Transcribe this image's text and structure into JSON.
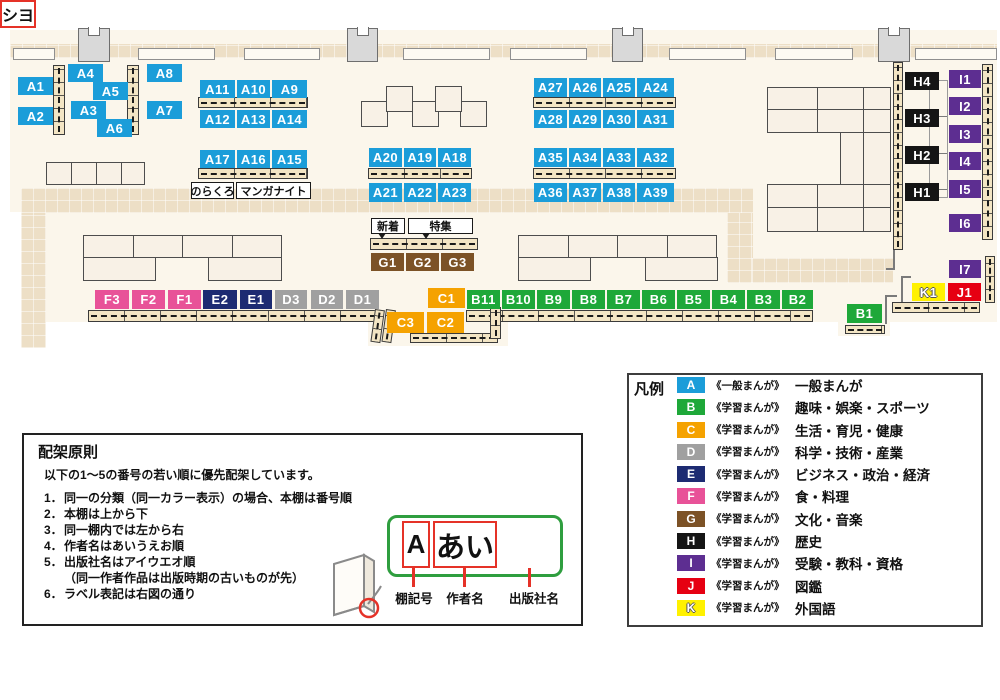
{
  "palette": {
    "A": "#1B9DD9",
    "B": "#1EA839",
    "C": "#F5A200",
    "D": "#A0A0A0",
    "E": "#1D2B72",
    "F": "#E85298",
    "G": "#7C5226",
    "H": "#151515",
    "I": "#5D2E91",
    "J": "#E60012",
    "K": "#FFF100"
  },
  "map": {
    "floor": {
      "x": 10,
      "y": 30,
      "w": 987,
      "h": 292
    },
    "floor_extensions": [
      {
        "x": 368,
        "y": 322,
        "w": 140,
        "h": 24
      },
      {
        "x": 838,
        "y": 322,
        "w": 52,
        "h": 14
      }
    ],
    "white_patches": [
      {
        "x": 0,
        "y": 212,
        "w": 21,
        "h": 110
      }
    ],
    "walkways": [
      {
        "x": 10,
        "y": 44,
        "w": 987,
        "h": 14
      },
      {
        "x": 21,
        "y": 188,
        "w": 25,
        "h": 160
      },
      {
        "x": 21,
        "y": 188,
        "w": 732,
        "h": 25
      },
      {
        "x": 727,
        "y": 213,
        "w": 26,
        "h": 70
      },
      {
        "x": 752,
        "y": 258,
        "w": 141,
        "h": 25
      }
    ],
    "wall_segments": [
      {
        "x": 13,
        "y": 48,
        "w": 42,
        "h": 12
      },
      {
        "x": 138,
        "y": 48,
        "w": 77,
        "h": 12
      },
      {
        "x": 244,
        "y": 48,
        "w": 76,
        "h": 12
      },
      {
        "x": 403,
        "y": 48,
        "w": 87,
        "h": 12
      },
      {
        "x": 510,
        "y": 48,
        "w": 77,
        "h": 12
      },
      {
        "x": 669,
        "y": 48,
        "w": 77,
        "h": 12
      },
      {
        "x": 775,
        "y": 48,
        "w": 78,
        "h": 12
      },
      {
        "x": 915,
        "y": 48,
        "w": 82,
        "h": 12
      }
    ],
    "pillars": [
      {
        "x": 78,
        "y": 28,
        "w": 32,
        "h": 34
      },
      {
        "x": 347,
        "y": 28,
        "w": 31,
        "h": 34
      },
      {
        "x": 612,
        "y": 28,
        "w": 31,
        "h": 34
      },
      {
        "x": 878,
        "y": 28,
        "w": 32,
        "h": 34
      }
    ],
    "tables": [
      {
        "x": 46,
        "y": 162,
        "w": 26,
        "h": 23
      },
      {
        "x": 71,
        "y": 162,
        "w": 26,
        "h": 23
      },
      {
        "x": 96,
        "y": 162,
        "w": 26,
        "h": 23
      },
      {
        "x": 121,
        "y": 162,
        "w": 24,
        "h": 23
      },
      {
        "x": 83,
        "y": 235,
        "w": 51,
        "h": 23
      },
      {
        "x": 133,
        "y": 235,
        "w": 50,
        "h": 23
      },
      {
        "x": 182,
        "y": 235,
        "w": 51,
        "h": 23
      },
      {
        "x": 232,
        "y": 235,
        "w": 50,
        "h": 23
      },
      {
        "x": 83,
        "y": 257,
        "w": 73,
        "h": 24
      },
      {
        "x": 208,
        "y": 257,
        "w": 74,
        "h": 24
      },
      {
        "x": 518,
        "y": 235,
        "w": 51,
        "h": 23
      },
      {
        "x": 568,
        "y": 235,
        "w": 50,
        "h": 23
      },
      {
        "x": 617,
        "y": 235,
        "w": 51,
        "h": 23
      },
      {
        "x": 667,
        "y": 235,
        "w": 50,
        "h": 23
      },
      {
        "x": 518,
        "y": 257,
        "w": 73,
        "h": 24
      },
      {
        "x": 645,
        "y": 257,
        "w": 73,
        "h": 24
      },
      {
        "x": 361,
        "y": 101,
        "w": 27,
        "h": 26
      },
      {
        "x": 412,
        "y": 101,
        "w": 27,
        "h": 26
      },
      {
        "x": 460,
        "y": 101,
        "w": 27,
        "h": 26
      },
      {
        "x": 386,
        "y": 86,
        "w": 27,
        "h": 26
      },
      {
        "x": 435,
        "y": 86,
        "w": 27,
        "h": 26
      },
      {
        "x": 767,
        "y": 87,
        "w": 51,
        "h": 23
      },
      {
        "x": 817,
        "y": 87,
        "w": 47,
        "h": 23
      },
      {
        "x": 863,
        "y": 87,
        "w": 28,
        "h": 23
      },
      {
        "x": 767,
        "y": 109,
        "w": 51,
        "h": 24
      },
      {
        "x": 817,
        "y": 109,
        "w": 47,
        "h": 24
      },
      {
        "x": 863,
        "y": 109,
        "w": 28,
        "h": 24
      },
      {
        "x": 840,
        "y": 132,
        "w": 24,
        "h": 53
      },
      {
        "x": 863,
        "y": 132,
        "w": 28,
        "h": 53
      },
      {
        "x": 767,
        "y": 184,
        "w": 51,
        "h": 24
      },
      {
        "x": 817,
        "y": 184,
        "w": 47,
        "h": 24
      },
      {
        "x": 863,
        "y": 184,
        "w": 28,
        "h": 24
      },
      {
        "x": 767,
        "y": 207,
        "w": 51,
        "h": 25
      },
      {
        "x": 817,
        "y": 207,
        "w": 47,
        "h": 25
      },
      {
        "x": 863,
        "y": 207,
        "w": 28,
        "h": 25
      }
    ],
    "shelves_h": [
      {
        "x": 198,
        "y": 97,
        "w": 110,
        "h": 11
      },
      {
        "x": 198,
        "y": 168,
        "w": 110,
        "h": 11
      },
      {
        "x": 368,
        "y": 168,
        "w": 104,
        "h": 11
      },
      {
        "x": 533,
        "y": 97,
        "w": 143,
        "h": 11
      },
      {
        "x": 533,
        "y": 168,
        "w": 143,
        "h": 11
      },
      {
        "x": 370,
        "y": 238,
        "w": 108,
        "h": 12
      },
      {
        "x": 88,
        "y": 310,
        "w": 291,
        "h": 12
      },
      {
        "x": 466,
        "y": 310,
        "w": 347,
        "h": 12
      },
      {
        "x": 845,
        "y": 325,
        "w": 40,
        "h": 9
      },
      {
        "x": 410,
        "y": 333,
        "w": 88,
        "h": 10
      },
      {
        "x": 892,
        "y": 302,
        "w": 88,
        "h": 11
      }
    ],
    "shelves_v": [
      {
        "x": 53,
        "y": 65,
        "w": 12,
        "h": 70
      },
      {
        "x": 127,
        "y": 65,
        "w": 12,
        "h": 70
      },
      {
        "x": 893,
        "y": 62,
        "w": 10,
        "h": 188
      },
      {
        "x": 982,
        "y": 64,
        "w": 11,
        "h": 176
      },
      {
        "x": 985,
        "y": 256,
        "w": 10,
        "h": 47
      },
      {
        "x": 375,
        "y": 309,
        "w": 10,
        "h": 33,
        "r": 8
      },
      {
        "x": 386,
        "y": 309,
        "w": 10,
        "h": 33,
        "r": 8
      },
      {
        "x": 490,
        "y": 307,
        "w": 11,
        "h": 32
      }
    ],
    "lines": [
      {
        "x": 893,
        "y": 234,
        "w": 2,
        "h": 36
      },
      {
        "x": 886,
        "y": 268,
        "w": 9,
        "h": 2
      },
      {
        "x": 901,
        "y": 276,
        "w": 2,
        "h": 30
      },
      {
        "x": 901,
        "y": 276,
        "w": 10,
        "h": 2
      },
      {
        "x": 885,
        "y": 296,
        "w": 2,
        "h": 28
      },
      {
        "x": 885,
        "y": 295,
        "w": 12,
        "h": 2
      },
      {
        "x": 929,
        "y": 116,
        "w": 19,
        "h": 1
      },
      {
        "x": 929,
        "y": 153,
        "w": 19,
        "h": 1
      },
      {
        "x": 929,
        "y": 189,
        "w": 19,
        "h": 1
      }
    ],
    "frames": [
      {
        "x": 929,
        "y": 80,
        "w": 19,
        "h": 118
      }
    ],
    "labels": [
      {
        "t": "A1",
        "c": "A",
        "x": 18,
        "y": 77,
        "w": 35,
        "h": 18
      },
      {
        "t": "A2",
        "c": "A",
        "x": 18,
        "y": 107,
        "w": 35,
        "h": 18
      },
      {
        "t": "A4",
        "c": "A",
        "x": 68,
        "y": 64,
        "w": 35,
        "h": 18
      },
      {
        "t": "A5",
        "c": "A",
        "x": 93,
        "y": 82,
        "w": 35,
        "h": 18
      },
      {
        "t": "A3",
        "c": "A",
        "x": 71,
        "y": 101,
        "w": 35,
        "h": 18
      },
      {
        "t": "A6",
        "c": "A",
        "x": 97,
        "y": 119,
        "w": 35,
        "h": 18
      },
      {
        "t": "A8",
        "c": "A",
        "x": 147,
        "y": 64,
        "w": 35,
        "h": 18
      },
      {
        "t": "A7",
        "c": "A",
        "x": 147,
        "y": 101,
        "w": 35,
        "h": 18
      },
      {
        "t": "A11",
        "c": "A",
        "x": 200,
        "y": 80,
        "w": 35,
        "h": 18
      },
      {
        "t": "A10",
        "c": "A",
        "x": 237,
        "y": 80,
        "w": 33,
        "h": 18
      },
      {
        "t": "A9",
        "c": "A",
        "x": 272,
        "y": 80,
        "w": 35,
        "h": 18
      },
      {
        "t": "A12",
        "c": "A",
        "x": 200,
        "y": 110,
        "w": 35,
        "h": 18
      },
      {
        "t": "A13",
        "c": "A",
        "x": 237,
        "y": 110,
        "w": 33,
        "h": 18
      },
      {
        "t": "A14",
        "c": "A",
        "x": 272,
        "y": 110,
        "w": 35,
        "h": 18
      },
      {
        "t": "A17",
        "c": "A",
        "x": 200,
        "y": 150,
        "w": 35,
        "h": 18
      },
      {
        "t": "A16",
        "c": "A",
        "x": 237,
        "y": 150,
        "w": 33,
        "h": 18
      },
      {
        "t": "A15",
        "c": "A",
        "x": 272,
        "y": 150,
        "w": 35,
        "h": 18
      },
      {
        "t": "A20",
        "c": "A",
        "x": 369,
        "y": 148,
        "w": 33,
        "h": 19
      },
      {
        "t": "A19",
        "c": "A",
        "x": 404,
        "y": 148,
        "w": 32,
        "h": 19
      },
      {
        "t": "A18",
        "c": "A",
        "x": 438,
        "y": 148,
        "w": 33,
        "h": 19
      },
      {
        "t": "A21",
        "c": "A",
        "x": 369,
        "y": 183,
        "w": 33,
        "h": 19
      },
      {
        "t": "A22",
        "c": "A",
        "x": 404,
        "y": 183,
        "w": 32,
        "h": 19
      },
      {
        "t": "A23",
        "c": "A",
        "x": 438,
        "y": 183,
        "w": 33,
        "h": 19
      },
      {
        "t": "A27",
        "c": "A",
        "x": 534,
        "y": 78,
        "w": 33,
        "h": 19
      },
      {
        "t": "A26",
        "c": "A",
        "x": 569,
        "y": 78,
        "w": 32,
        "h": 19
      },
      {
        "t": "A25",
        "c": "A",
        "x": 603,
        "y": 78,
        "w": 32,
        "h": 19
      },
      {
        "t": "A24",
        "c": "A",
        "x": 637,
        "y": 78,
        "w": 37,
        "h": 19
      },
      {
        "t": "A28",
        "c": "A",
        "x": 534,
        "y": 110,
        "w": 33,
        "h": 18
      },
      {
        "t": "A29",
        "c": "A",
        "x": 569,
        "y": 110,
        "w": 32,
        "h": 18
      },
      {
        "t": "A30",
        "c": "A",
        "x": 603,
        "y": 110,
        "w": 32,
        "h": 18
      },
      {
        "t": "A31",
        "c": "A",
        "x": 637,
        "y": 110,
        "w": 37,
        "h": 18
      },
      {
        "t": "A35",
        "c": "A",
        "x": 534,
        "y": 148,
        "w": 33,
        "h": 19
      },
      {
        "t": "A34",
        "c": "A",
        "x": 569,
        "y": 148,
        "w": 32,
        "h": 19
      },
      {
        "t": "A33",
        "c": "A",
        "x": 603,
        "y": 148,
        "w": 32,
        "h": 19
      },
      {
        "t": "A32",
        "c": "A",
        "x": 637,
        "y": 148,
        "w": 37,
        "h": 19
      },
      {
        "t": "A36",
        "c": "A",
        "x": 534,
        "y": 183,
        "w": 33,
        "h": 19
      },
      {
        "t": "A37",
        "c": "A",
        "x": 569,
        "y": 183,
        "w": 32,
        "h": 19
      },
      {
        "t": "A38",
        "c": "A",
        "x": 603,
        "y": 183,
        "w": 32,
        "h": 19
      },
      {
        "t": "A39",
        "c": "A",
        "x": 637,
        "y": 183,
        "w": 37,
        "h": 19
      },
      {
        "t": "G1",
        "c": "G",
        "x": 371,
        "y": 253,
        "w": 33,
        "h": 18
      },
      {
        "t": "G2",
        "c": "G",
        "x": 406,
        "y": 253,
        "w": 33,
        "h": 18
      },
      {
        "t": "G3",
        "c": "G",
        "x": 441,
        "y": 253,
        "w": 33,
        "h": 18
      },
      {
        "t": "F3",
        "c": "F",
        "x": 95,
        "y": 290,
        "w": 34,
        "h": 19
      },
      {
        "t": "F2",
        "c": "F",
        "x": 132,
        "y": 290,
        "w": 33,
        "h": 19
      },
      {
        "t": "F1",
        "c": "F",
        "x": 168,
        "y": 290,
        "w": 33,
        "h": 19
      },
      {
        "t": "E2",
        "c": "E",
        "x": 203,
        "y": 290,
        "w": 34,
        "h": 19
      },
      {
        "t": "E1",
        "c": "E",
        "x": 240,
        "y": 290,
        "w": 32,
        "h": 19
      },
      {
        "t": "D3",
        "c": "D",
        "x": 275,
        "y": 290,
        "w": 32,
        "h": 19
      },
      {
        "t": "D2",
        "c": "D",
        "x": 311,
        "y": 290,
        "w": 32,
        "h": 19
      },
      {
        "t": "D1",
        "c": "D",
        "x": 346,
        "y": 290,
        "w": 33,
        "h": 19
      },
      {
        "t": "C1",
        "c": "C",
        "x": 428,
        "y": 288,
        "w": 37,
        "h": 20
      },
      {
        "t": "C3",
        "c": "C",
        "x": 387,
        "y": 312,
        "w": 37,
        "h": 21
      },
      {
        "t": "C2",
        "c": "C",
        "x": 427,
        "y": 312,
        "w": 37,
        "h": 21
      },
      {
        "t": "B11",
        "c": "B",
        "x": 467,
        "y": 290,
        "w": 33,
        "h": 19
      },
      {
        "t": "B10",
        "c": "B",
        "x": 502,
        "y": 290,
        "w": 33,
        "h": 19
      },
      {
        "t": "B9",
        "c": "B",
        "x": 537,
        "y": 290,
        "w": 33,
        "h": 19
      },
      {
        "t": "B8",
        "c": "B",
        "x": 572,
        "y": 290,
        "w": 33,
        "h": 19
      },
      {
        "t": "B7",
        "c": "B",
        "x": 607,
        "y": 290,
        "w": 33,
        "h": 19
      },
      {
        "t": "B6",
        "c": "B",
        "x": 642,
        "y": 290,
        "w": 33,
        "h": 19
      },
      {
        "t": "B5",
        "c": "B",
        "x": 677,
        "y": 290,
        "w": 33,
        "h": 19
      },
      {
        "t": "B4",
        "c": "B",
        "x": 712,
        "y": 290,
        "w": 33,
        "h": 19
      },
      {
        "t": "B3",
        "c": "B",
        "x": 747,
        "y": 290,
        "w": 33,
        "h": 19
      },
      {
        "t": "B2",
        "c": "B",
        "x": 782,
        "y": 290,
        "w": 31,
        "h": 19
      },
      {
        "t": "B1",
        "c": "B",
        "x": 847,
        "y": 304,
        "w": 35,
        "h": 19
      },
      {
        "t": "H4",
        "c": "H",
        "x": 905,
        "y": 72,
        "w": 34,
        "h": 18
      },
      {
        "t": "H3",
        "c": "H",
        "x": 905,
        "y": 109,
        "w": 34,
        "h": 18
      },
      {
        "t": "H2",
        "c": "H",
        "x": 905,
        "y": 146,
        "w": 34,
        "h": 18
      },
      {
        "t": "H1",
        "c": "H",
        "x": 905,
        "y": 183,
        "w": 34,
        "h": 18
      },
      {
        "t": "I1",
        "c": "I",
        "x": 949,
        "y": 70,
        "w": 32,
        "h": 18
      },
      {
        "t": "I2",
        "c": "I",
        "x": 949,
        "y": 97,
        "w": 32,
        "h": 18
      },
      {
        "t": "I3",
        "c": "I",
        "x": 949,
        "y": 125,
        "w": 32,
        "h": 18
      },
      {
        "t": "I4",
        "c": "I",
        "x": 949,
        "y": 152,
        "w": 32,
        "h": 18
      },
      {
        "t": "I5",
        "c": "I",
        "x": 949,
        "y": 180,
        "w": 32,
        "h": 18
      },
      {
        "t": "I6",
        "c": "I",
        "x": 949,
        "y": 214,
        "w": 32,
        "h": 18
      },
      {
        "t": "I7",
        "c": "I",
        "x": 949,
        "y": 260,
        "w": 32,
        "h": 18
      },
      {
        "t": "K1",
        "c": "K",
        "x": 912,
        "y": 283,
        "w": 33,
        "h": 18
      },
      {
        "t": "J1",
        "c": "J",
        "x": 948,
        "y": 283,
        "w": 33,
        "h": 18
      }
    ],
    "callouts": [
      {
        "t": "のらくろ",
        "x": 191,
        "y": 182,
        "w": 43,
        "h": 17,
        "tail": false
      },
      {
        "t": "マンガナイト",
        "x": 236,
        "y": 182,
        "w": 75,
        "h": 17,
        "tail": false
      },
      {
        "t": "新着",
        "x": 371,
        "y": 218,
        "w": 34,
        "h": 16,
        "tail": true
      },
      {
        "t": "特集",
        "x": 408,
        "y": 218,
        "w": 65,
        "h": 16,
        "tail": true
      }
    ]
  },
  "legend": {
    "title": "凡例",
    "items": [
      {
        "code": "A",
        "scope": "《一般まんが》",
        "category": "一般まんが"
      },
      {
        "code": "B",
        "scope": "《学習まんが》",
        "category": "趣味・娯楽・スポーツ"
      },
      {
        "code": "C",
        "scope": "《学習まんが》",
        "category": "生活・育児・健康"
      },
      {
        "code": "D",
        "scope": "《学習まんが》",
        "category": "科学・技術・産業"
      },
      {
        "code": "E",
        "scope": "《学習まんが》",
        "category": "ビジネス・政治・経済"
      },
      {
        "code": "F",
        "scope": "《学習まんが》",
        "category": "食・料理"
      },
      {
        "code": "G",
        "scope": "《学習まんが》",
        "category": "文化・音楽"
      },
      {
        "code": "H",
        "scope": "《学習まんが》",
        "category": "歴史"
      },
      {
        "code": "I",
        "scope": "《学習まんが》",
        "category": "受験・教科・資格"
      },
      {
        "code": "J",
        "scope": "《学習まんが》",
        "category": "図鑑"
      },
      {
        "code": "K",
        "scope": "《学習まんが》",
        "category": "外国語"
      }
    ]
  },
  "principles": {
    "title": "配架原則",
    "intro": "以下の1～5の番号の若い順に優先配架しています。",
    "items": [
      {
        "no": "1．",
        "text": "同一の分類（同一カラー表示）の場合、本棚は番号順"
      },
      {
        "no": "2．",
        "text": "本棚は上から下"
      },
      {
        "no": "3．",
        "text": "同一棚内では左から右"
      },
      {
        "no": "4．",
        "text": "作者名はあいうえお順"
      },
      {
        "no": "5．",
        "text": "出版社名はアイウエオ順"
      },
      {
        "no": "",
        "text": "（同一作者作品は出版時期の古いものが先）"
      },
      {
        "no": "6．",
        "text": "ラベル表記は右図の通り"
      }
    ],
    "label_example": {
      "shelf_code": "A",
      "author": "あい",
      "publisher": "シヨ",
      "captions": [
        "棚記号",
        "作者名",
        "出版社名"
      ]
    }
  }
}
